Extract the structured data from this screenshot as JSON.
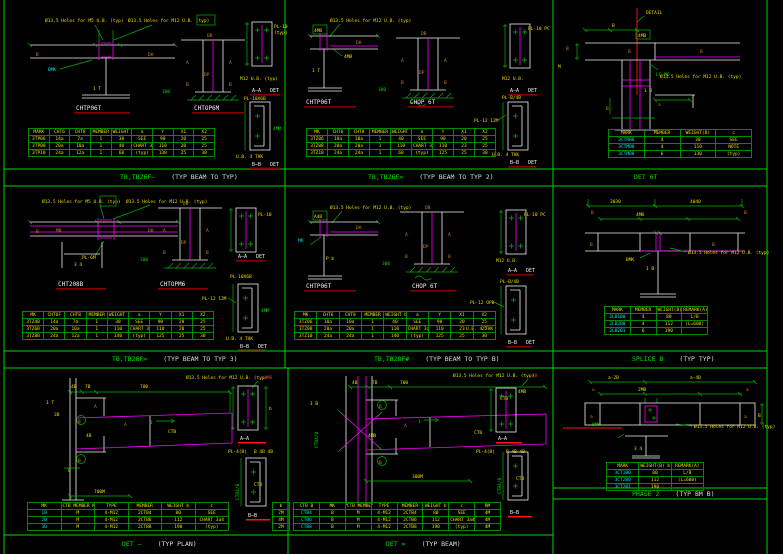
{
  "colors": {
    "background": "#000000",
    "line_green": "#00b400",
    "text_green": "#00d800",
    "magenta": "#ff00ff",
    "yellow": "#f0df00",
    "cyan": "#00e5e5",
    "white": "#eeeeee",
    "red": "#ff1515",
    "dark_red": "#8a0000",
    "orange": "#c9831c"
  },
  "panels": [
    {
      "note1": "Ø13.5 Holes for M5 U.B. (typ)",
      "note2": "Ø13.5 Holes for M12 U.B. (typ)",
      "t1": "CHTP06T",
      "t2": "CHTOP6M",
      "labels": {
        "b": "B",
        "dh": "DH",
        "web": "1 T",
        "mk": "BMK",
        "db": "DB",
        "a1": "A",
        "a2": "A",
        "dp": "DP",
        "b1": "B",
        "b2": "B",
        "base": "300"
      },
      "secA": {
        "pl": "PL-10",
        "pl2": "(typ)",
        "bolt": "M12 U.B. (typ)",
        "cap": "A—A",
        "det": "DET"
      },
      "secB": {
        "pl": "PL-10X6B",
        "note": "U.B. 4 THK",
        "dim": "4MM",
        "cap": "B—B",
        "det": "DET"
      },
      "table": {
        "headers": [
          "MARK",
          "CHT6",
          "CHT8",
          "MEMBER",
          "WEIGHT b",
          "a",
          "Y",
          "X1",
          "X2"
        ],
        "rows": [
          [
            "3TP06",
            "14a",
            "7a",
            "1",
            "30",
            "SEE",
            "90",
            "20",
            "25"
          ],
          [
            "3TP08",
            "20a",
            "10a",
            "1",
            "40",
            "CHART 3a4",
            "110",
            "20",
            "25"
          ],
          [
            "3TP10",
            "24a",
            "12a",
            "1",
            "60",
            "(typ)",
            "130",
            "25",
            "30"
          ]
        ]
      },
      "cap_g": "TB,TB26F—",
      "cap_w": "(TYP BEAM TO TYP)"
    },
    {
      "note1": "Ø13.5 Holes for M12 U.B. (typ)",
      "small": "4MB",
      "t1": "CHTP06T",
      "t2": "CHOP 6T",
      "labels": {
        "dh": "DH",
        "web": "1 T",
        "pl": "4MB",
        "db": "DB",
        "a1": "A",
        "a2": "A",
        "dp": "DP",
        "b1": "B",
        "b2": "B",
        "base": "300"
      },
      "secA": {
        "pl": "PL-10 PC",
        "bolt": "M12 U.B.",
        "cap": "A—A",
        "det": "DET"
      },
      "secB": {
        "pl": "PL-B/4B",
        "leader": "PL-12 12M",
        "note": "U.B. 4 THK",
        "cap": "B—B",
        "det": "DET"
      },
      "table": {
        "headers": [
          "MK",
          "CHT6",
          "CHT8",
          "MEMBER",
          "WEIGHT b",
          "a",
          "Y",
          "X1",
          "X2"
        ],
        "rows": [
          [
            "3TZ06",
            "10a",
            "10a",
            "1",
            "40",
            "SEE",
            "90",
            "20",
            "25"
          ],
          [
            "3TZ08",
            "20a",
            "20a",
            "1",
            "110",
            "CHART 3a4",
            "110",
            "23",
            "25"
          ],
          [
            "3TZ10",
            "24a",
            "24a",
            "1",
            "60",
            "(typ)",
            "125",
            "25",
            "30"
          ]
        ]
      },
      "cap_g": "TB,TB26F=",
      "cap_w": "(TYP BEAM TO TYP 2)"
    },
    {
      "note_top": "DETAIL",
      "small": "4MB",
      "note1": "Ø13.5 Holes for M12 U.B. (typ)",
      "labels": {
        "d1": "B",
        "lb": "B",
        "m": "M",
        "cb": "B",
        "lc": "LC M6",
        "rb": "B",
        "web": "1 B",
        "a": "a",
        "bb": "B"
      },
      "table": {
        "headers": [
          "MARK",
          "MEMBER",
          "WEIGHT(B)",
          "c"
        ],
        "c0": "cyan",
        "rows": [
          [
            "3CTRB6",
            "4",
            "30",
            "SEE"
          ],
          [
            "3CTMB8",
            "4",
            "110",
            "NOTE"
          ],
          [
            "3CTMB8",
            "6",
            "130",
            "(typ)"
          ]
        ]
      },
      "cap_g": "DET 6T",
      "cap_w": ""
    },
    {
      "note1": "Ø13.5 Holes for M5 U.B. (typ)",
      "note2": "Ø13.5 Holes for M12 U.B. (typ)",
      "t1": "CHT208B",
      "t2": "CHTOPM6",
      "labels": {
        "b": "B",
        "mb": "MB",
        "dh": "DH",
        "pl": "PL-6M",
        "web": "3 4",
        "db": "DB",
        "a1": "A",
        "a2": "A",
        "dp": "DP",
        "b1": "B",
        "b2": "B",
        "base": "300"
      },
      "secA": {
        "pl": "PL-10",
        "cap": "A—A",
        "det": "DET"
      },
      "secB": {
        "pl": "PL-10X6B",
        "leader": "PL-12 12M",
        "dim": "4MM",
        "note": "U.B. 4 THK",
        "cap": "B—B",
        "det": "DET"
      },
      "table": {
        "headers": [
          "MK",
          "CHT6F",
          "CHT8",
          "MEMBER",
          "WEIGHT b",
          "a",
          "Y",
          "X1",
          "X2"
        ],
        "rows": [
          [
            "3TZ4B",
            "14a",
            "7a",
            "1",
            "30",
            "SEE",
            "90",
            "20",
            "25"
          ],
          [
            "3TZ6B",
            "20a",
            "10a",
            "1",
            "110",
            "CHART 3a4",
            "110",
            "20",
            "25"
          ],
          [
            "3TZ8B",
            "24a",
            "12a",
            "1",
            "140",
            "(typ)",
            "125",
            "25",
            "30"
          ]
        ]
      },
      "cap_g": "TB,TB28F=",
      "cap_w": "(TYP BEAM TO TYP 3)"
    },
    {
      "note1": "Ø13.5 Holes for M12 U.B. (typ)",
      "small": "A4B",
      "t1": "CHTP06T",
      "t2": "CHOP 6T",
      "labels": {
        "mk": "MK",
        "pb": "P b",
        "dh": "DH",
        "db": "DB",
        "a1": "A",
        "a2": "A",
        "dp": "DP",
        "b1": "B",
        "b2": "B",
        "base": "300"
      },
      "secA": {
        "pl": "PL-10 PC",
        "bolt": "M12 U.B.",
        "cap": "A—A",
        "det": "DET"
      },
      "secB": {
        "pl": "PL-B/4B",
        "leader": "PL-12 OPB",
        "note": "U.B. 4 THK",
        "cap": "B—B",
        "det": "DET"
      },
      "table": {
        "headers": [
          "MK",
          "CHT6",
          "CHT8",
          "MEMBER",
          "WEIGHT b",
          "a",
          "Y",
          "X1",
          "X2"
        ],
        "rows": [
          [
            "3TZ06",
            "10a",
            "10a",
            "1",
            "40",
            "SEE",
            "90",
            "20",
            "25"
          ],
          [
            "3TZ08",
            "20a",
            "20a",
            "1",
            "110",
            "CHART 3a4",
            "110",
            "23",
            "25"
          ],
          [
            "3TZ10",
            "24a",
            "24a",
            "1",
            "140",
            "(typ)",
            "125",
            "25",
            "30"
          ]
        ]
      },
      "cap_g": "TB,TB28F#",
      "cap_w": "(TYP BEAM TO TYP B)"
    },
    {
      "d1": "3030",
      "d2": "4040",
      "d3": "4MB",
      "labels": {
        "b1": "B",
        "b2": "B",
        "b3": "B",
        "b4": "B",
        "mk": "BMK",
        "web": "1 B"
      },
      "note1": "Ø13.5 Holes for M12 U.B. (typ)",
      "table": {
        "headers": [
          "MARK",
          "MEMBER",
          "WEIGHT(B) b",
          "REMARK(A)"
        ],
        "c0": "cyan",
        "rows": [
          [
            "2LB1B0",
            "4",
            "80",
            "L/B"
          ],
          [
            "2LB2B0",
            "4",
            "112",
            "(L=600)"
          ],
          [
            "2LB2B1",
            "6",
            "190",
            ""
          ]
        ]
      },
      "cap_g": "SPLICE B",
      "cap_w": "(TYP TYP)"
    },
    {
      "note1": "Ø13.5 Holes for M12 U.B. (typ)",
      "red": "4MB",
      "dims": {
        "top": "700",
        "d1": "4B",
        "d2": "7B",
        "lt": "1 T",
        "l2": "3B",
        "bot": "700M",
        "q": "Q"
      },
      "labels": {
        "a1": "A",
        "b1": "B",
        "a2": "A",
        "b2": "B",
        "ctb": "CTB",
        "one": "1",
        "y4": "4B"
      },
      "secA": {
        "cap": "A—A",
        "pl": "PL-4(B)",
        "dims": "B 4B 4B",
        "b": "b"
      },
      "secB": {
        "ctb": "CTB",
        "rot": "CTB4/B",
        "cap": "B—B"
      },
      "table": {
        "headers": [
          "MK",
          "CTB MEMBER NO.(d,b)",
          "TYPE",
          "MEMBER",
          "WEIGHT b",
          "c"
        ],
        "c0": "cyan",
        "rows": [
          [
            "1B",
            "M",
            "4-M12",
            "2CTB4",
            "80",
            "SEE"
          ],
          [
            "2B",
            "M",
            "4-M12",
            "2CTB6",
            "112",
            "CHART 3a4"
          ],
          [
            "3B",
            "M",
            "4-M12",
            "2CTB8",
            "190",
            "(typ)"
          ]
        ]
      },
      "table2": {
        "headers": [
          "b"
        ],
        "rows": [
          [
            "7M"
          ],
          [
            "4M"
          ],
          [
            "2M"
          ]
        ]
      },
      "cap_g": "DET —",
      "cap_w": "(TYP PLAN)"
    },
    {
      "note1": "Ø13.5 Holes for M12 U.B. (typ)",
      "red": "4B",
      "dims": {
        "top": "700",
        "d1": "4B",
        "d2": "7B",
        "lt": "1 B",
        "bot": "300M"
      },
      "labels": {
        "rot": "CTB4/B",
        "b1": "B",
        "b2": "B",
        "a1": "A",
        "ctb": "CTB",
        "one": "1",
        "y4": "4MB"
      },
      "secA": {
        "ctb": "CTB",
        "pl": "4MB",
        "cap": "A—A"
      },
      "mid": {
        "pl": "PL-4(B)",
        "dims": "B 4B 4B"
      },
      "secB": {
        "ctb": "CTB",
        "rot": "CTB4/B",
        "cap": "B—B"
      },
      "table": {
        "headers": [
          "CTB B",
          "MK",
          "CTB MEMBER NO.(d,b)",
          "TYPE",
          "MEMBER",
          "WEIGHT b",
          "c",
          "RM"
        ],
        "c0": "cyan",
        "rows": [
          [
            "CTB4",
            "B",
            "M",
            "4-M12",
            "2CTB4",
            "80",
            "SEE",
            "4M"
          ],
          [
            "CTB6",
            "B",
            "M",
            "4-M12",
            "2CTB6",
            "112",
            "CHART 3a4",
            "4M"
          ],
          [
            "CTB8",
            "B",
            "M",
            "4-M12",
            "2CTB8",
            "190",
            "(typ)",
            "4M"
          ]
        ]
      },
      "cap_g": "DET =",
      "cap_w": "(TYP BEAM)"
    },
    {
      "dims": {
        "d1": "a-2B",
        "d2": "a-4B",
        "d3": "2MB",
        "a1": "a",
        "a2": "a",
        "a3": "a",
        "a4": "a",
        "b": "B",
        "web": "3 4"
      },
      "labels": {
        "mk": "BMK"
      },
      "note1": "Ø13.5 Holes for M12 U.B. (typ)",
      "table": {
        "headers": [
          "MARK",
          "WEIGHT(B) b",
          "REMARK(A)"
        ],
        "c0": "cyan",
        "rows": [
          [
            "3CT1B0",
            "80",
            "L/B"
          ],
          [
            "3CT2B0",
            "112",
            "(L=600)"
          ],
          [
            "3CT2B1",
            "190",
            ""
          ]
        ]
      },
      "cap_g": "PHASE 2",
      "cap_w": "(TYP BM B)"
    }
  ]
}
